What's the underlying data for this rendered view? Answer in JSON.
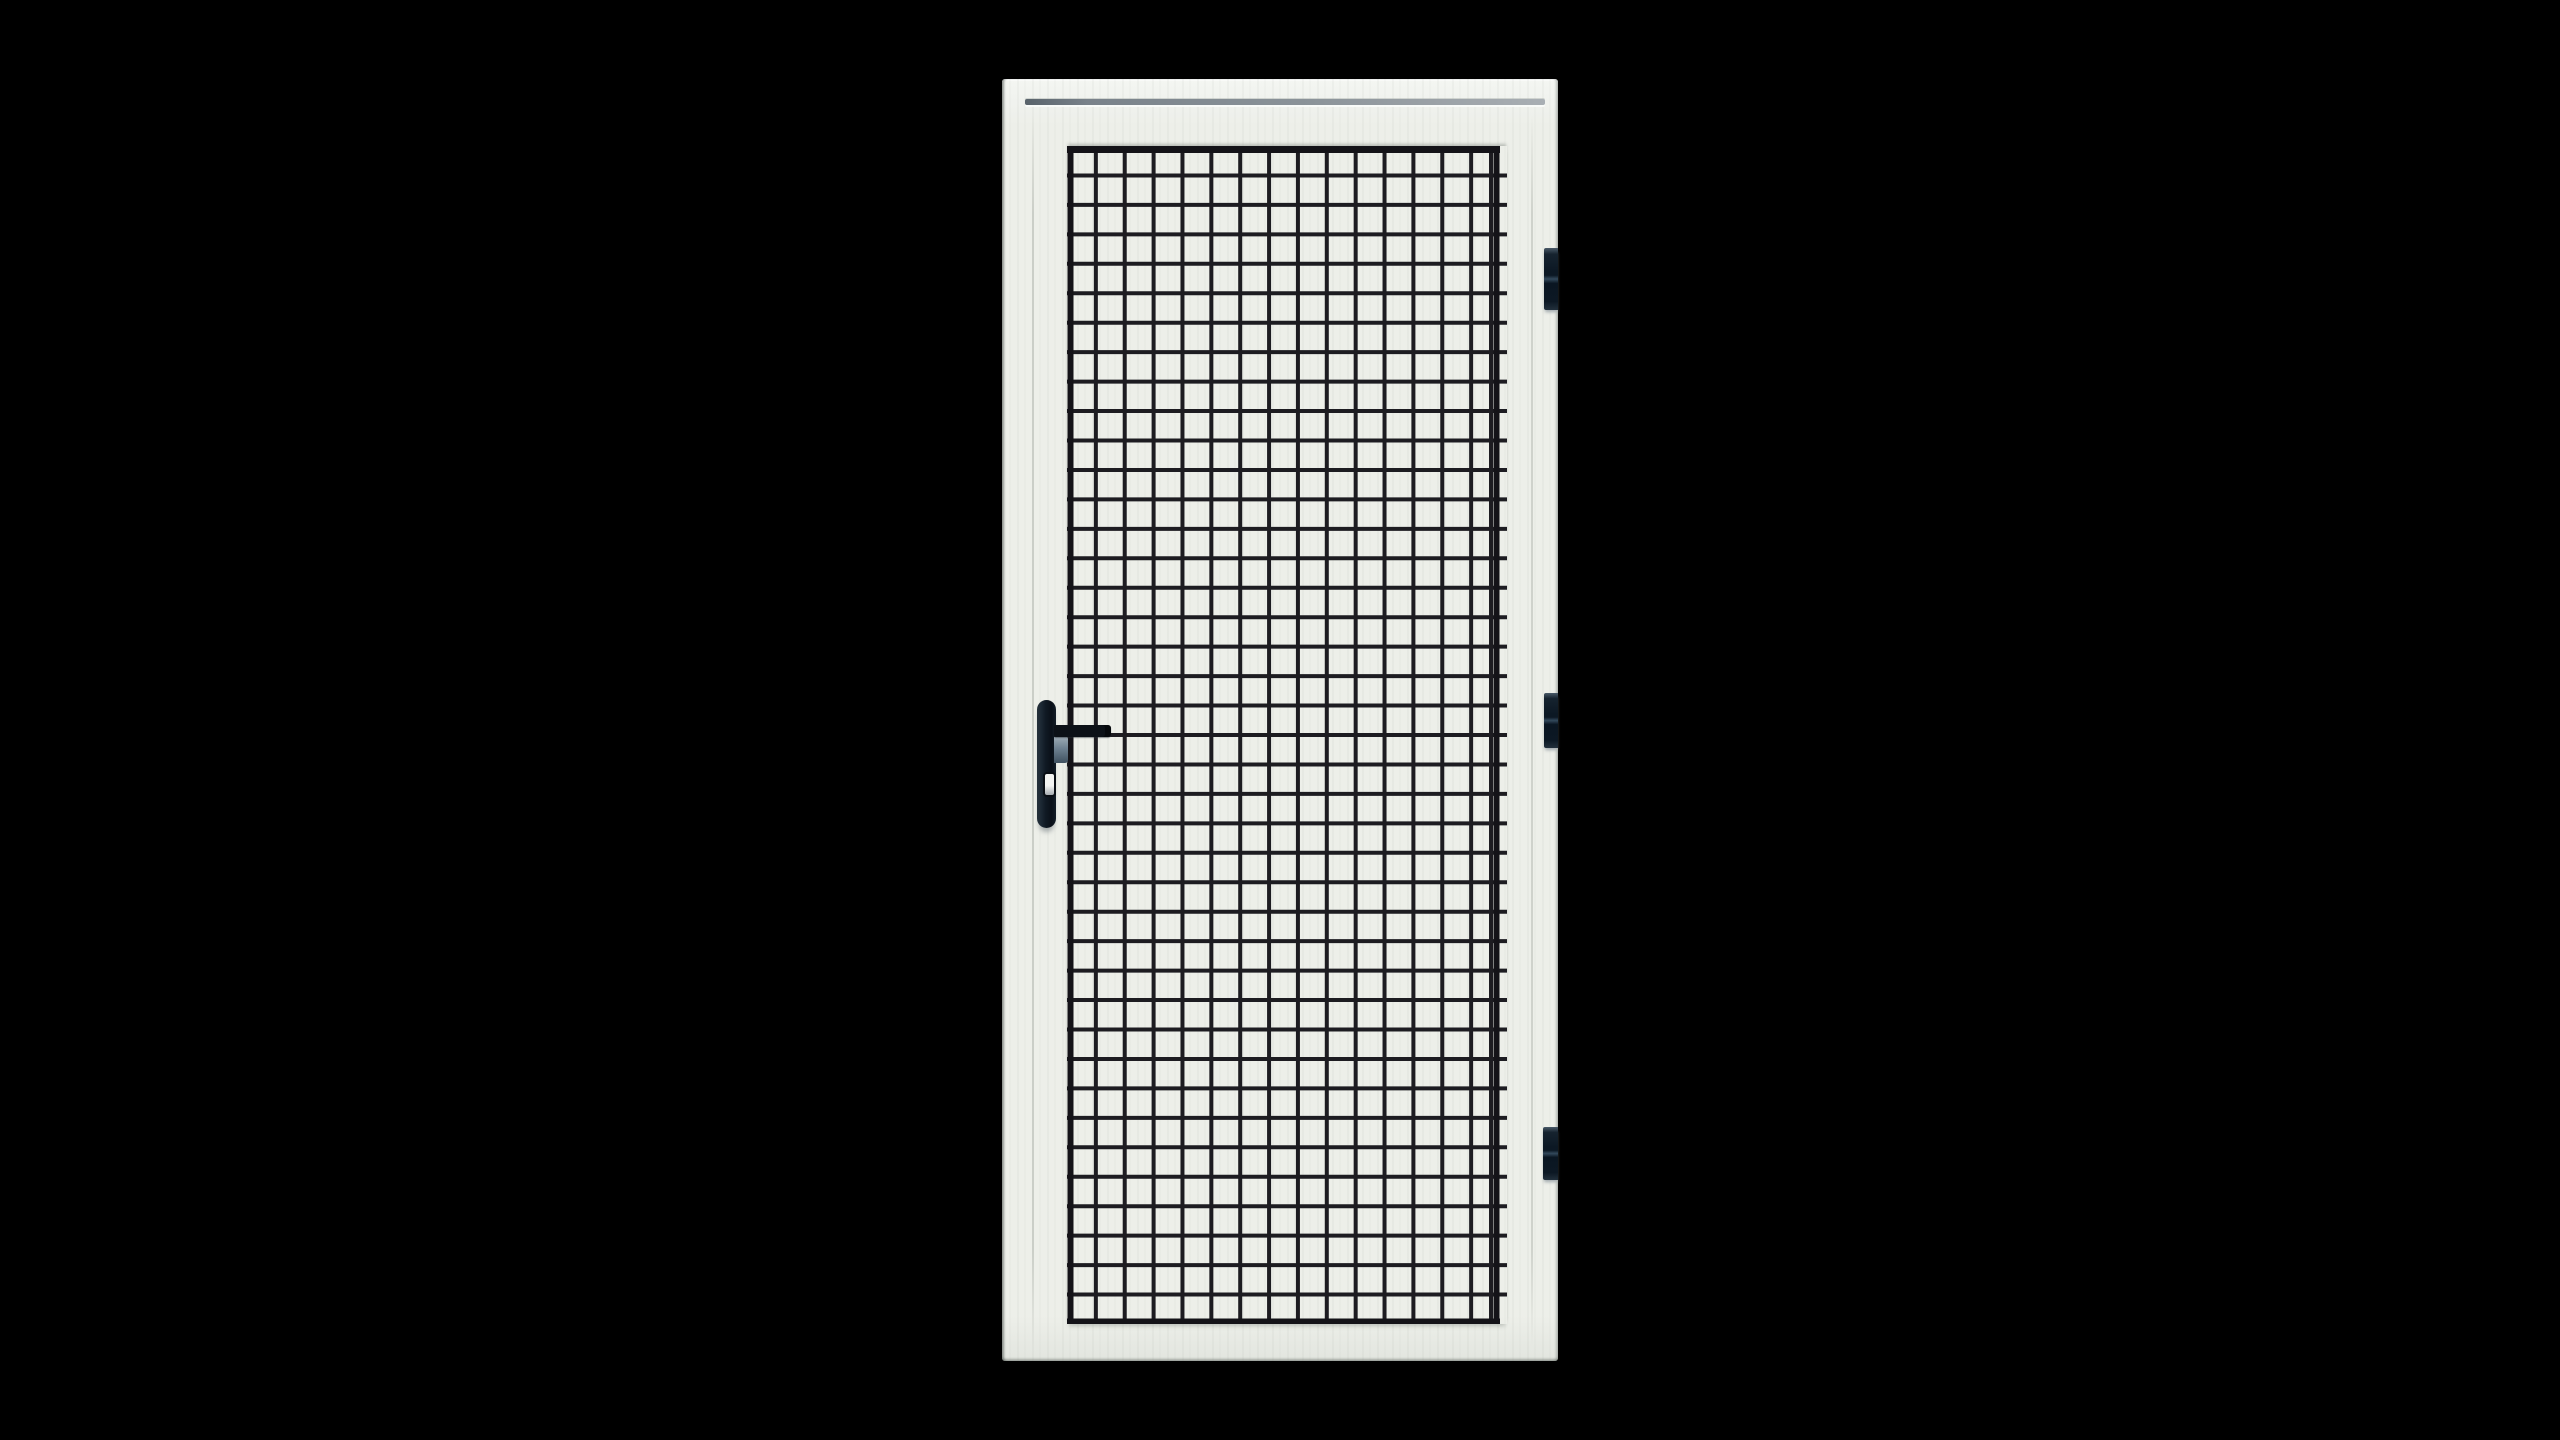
{
  "scene": {
    "type": "product-photo",
    "subject": "White aluminium security screen door with black welded steel mesh grille, lever handle on the left and three hinges on the right, isolated on a black background",
    "background_color": "#000000"
  },
  "door": {
    "position": {
      "left": 1002,
      "top": 79,
      "width": 556,
      "height": 1282
    },
    "colors": {
      "frame": "#edefe9",
      "frame_highlight": "#f4f6f2",
      "frame_edge_shadow": "#9aa096",
      "trim_groove_dark": "#59636b",
      "trim_groove_light": "#a9afb4"
    },
    "features": [
      "top-trim-groove",
      "left-stile-seam",
      "right-stile-seam"
    ]
  },
  "mesh": {
    "columns": 15,
    "rows": 40,
    "wire_color": "#1d1c21",
    "border_color": "#141318",
    "wire_thickness": 4,
    "border_thickness": 7,
    "extra_right_wire_inset": 9,
    "right_tip_extension": 7,
    "box": {
      "left": 65,
      "top": 67,
      "width": 433,
      "height": 1178
    }
  },
  "handle": {
    "side": "left",
    "style": "vertical backplate with lever and euro keyhole",
    "plate_color_dark": "#0a1018",
    "plate_color_light": "#1d2935",
    "lever_color": "#0c1117",
    "lock_body_light": "#9dabb5",
    "lock_body_dark": "#3f5160",
    "keyhole_color": "#f3f4f2",
    "keyhole_shadow": "#a7acb1"
  },
  "hinges": {
    "count": 3,
    "side": "right",
    "color_dark": "#0c1824",
    "color_mid": "#33495c",
    "positions_top_px": [
      169,
      614,
      1048
    ]
  }
}
